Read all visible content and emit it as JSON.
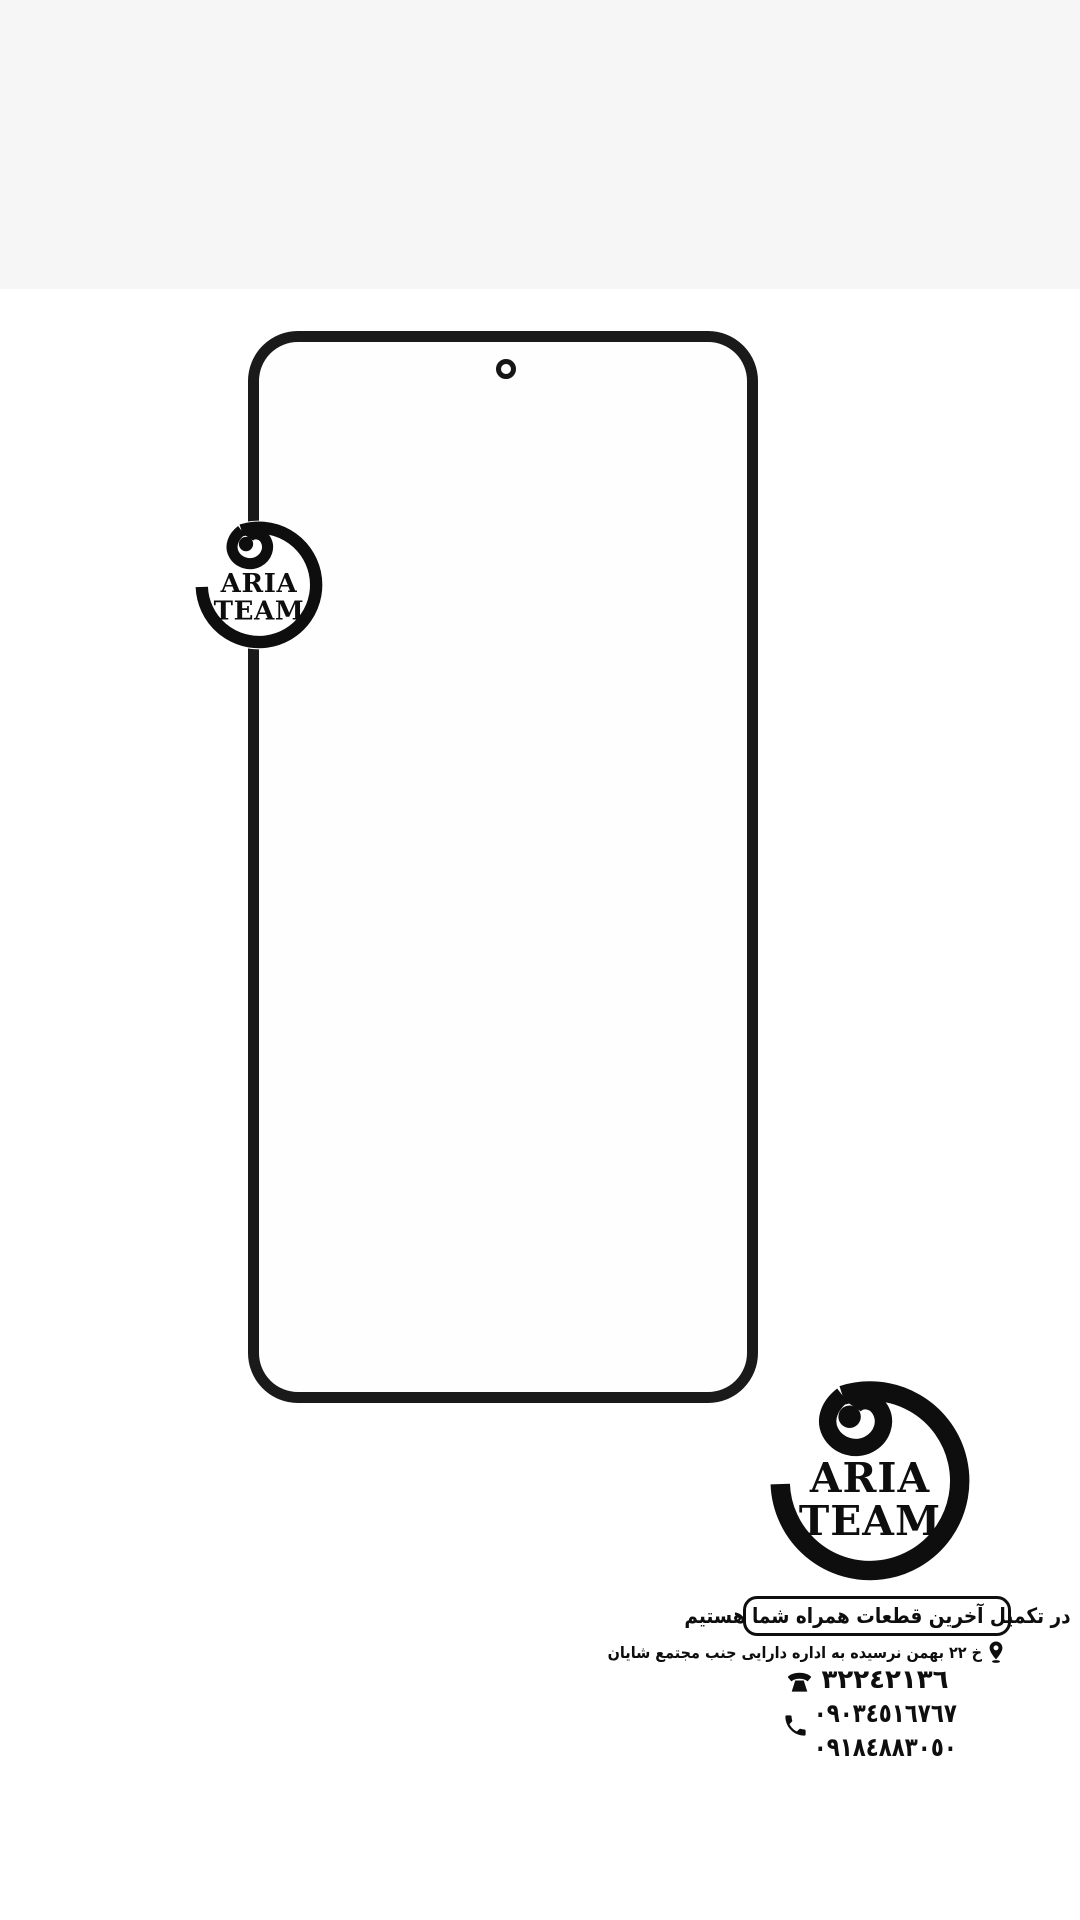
{
  "colors": {
    "background": "#ffffff",
    "top_band": "#f6f6f7",
    "ink": "#0e0e0e",
    "frame": "#1a1a1a"
  },
  "brand": {
    "name_line1": "ARIA",
    "name_line2": "TEAM"
  },
  "footer": {
    "slogan": "در تکمیل آخرین قطعات همراه شما هستیم",
    "address": "خ ٢٢ بهمن نرسیده به اداره دارایی جنب مجتمع شایان",
    "fax_number": "٣٢٢٤٢١٣٦",
    "mobile_numbers": [
      "٠٩٠٣٤٥١٦٧٦٧",
      "٠٩١٨٤٨٨٣٠٥٠"
    ],
    "icons": {
      "address": "location-pin-icon",
      "fax": "fax-phone-icon",
      "mobile": "phone-handset-icon"
    }
  }
}
